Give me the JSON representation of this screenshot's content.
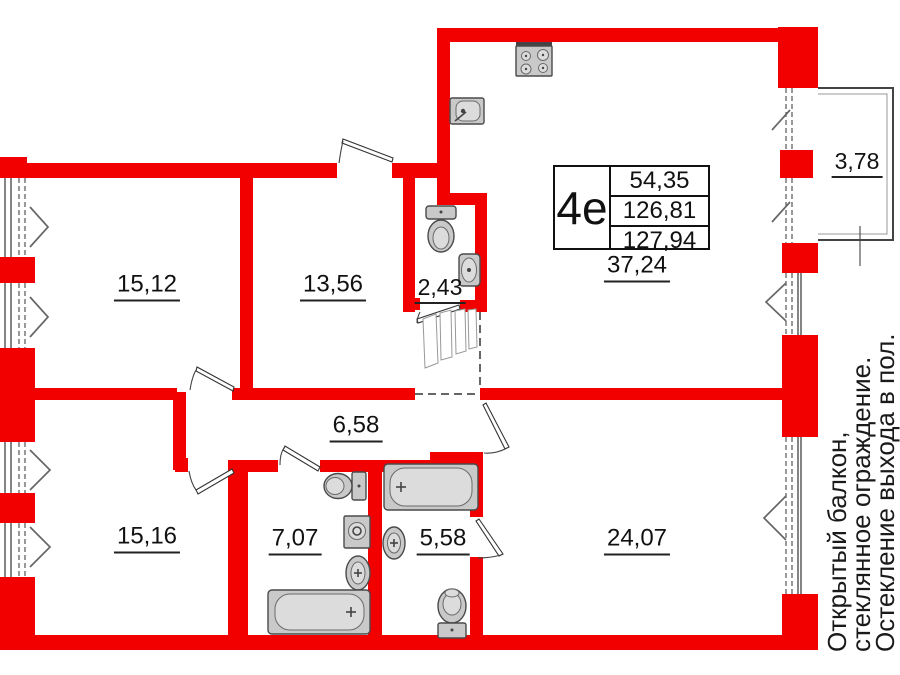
{
  "unit": {
    "type_label": "4е",
    "living_area": "54,35",
    "total_area": "126,81",
    "total_area_with_balcony": "127,94"
  },
  "rooms": [
    {
      "area": "15,12"
    },
    {
      "area": "13,56"
    },
    {
      "area": "2,43"
    },
    {
      "area": "37,24"
    },
    {
      "area": "6,58"
    },
    {
      "area": "15,16"
    },
    {
      "area": "7,07"
    },
    {
      "area": "5,58"
    },
    {
      "area": "24,07"
    }
  ],
  "balcony": {
    "area": "3,78"
  },
  "annotation": {
    "lines": [
      "Открытый балкон,",
      "стеклянное ограждение.",
      "Остекление выхода в пол."
    ]
  },
  "colors": {
    "wall_red": "#f20000",
    "fixture_gray": "#c9c9c9",
    "line_dark": "#333333",
    "text": "#111111"
  },
  "icons": [
    "stove-icon",
    "kitchen-sink-icon",
    "toilet-icon",
    "wash-basin-icon",
    "washing-machine-icon",
    "bathtub-icon",
    "wardrobe-icon",
    "window-chevron-icon",
    "door-swing-icon"
  ]
}
